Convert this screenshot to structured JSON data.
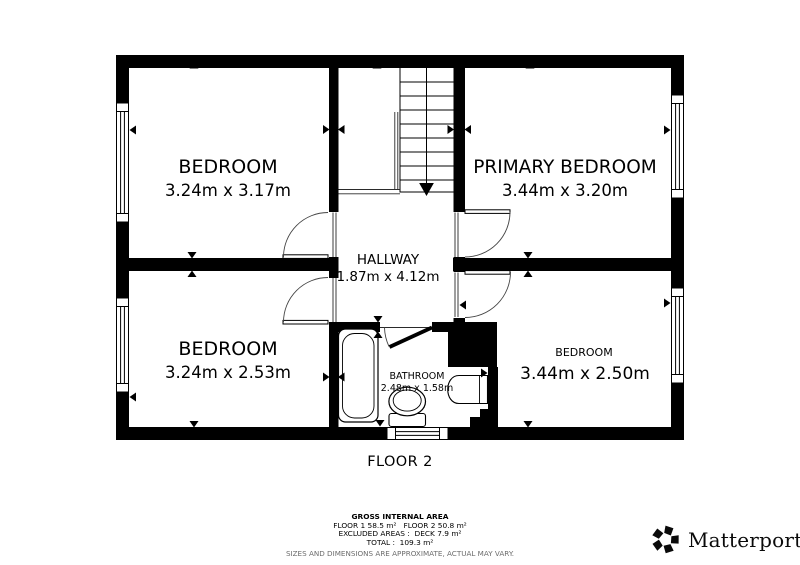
{
  "floor_label": "FLOOR 2",
  "rooms": {
    "bedroom_tl": {
      "name": "BEDROOM",
      "dims": "3.24m x 3.17m"
    },
    "primary": {
      "name": "PRIMARY BEDROOM",
      "dims": "3.44m x 3.20m"
    },
    "hallway": {
      "name": "HALLWAY",
      "dims": "1.87m x 4.12m"
    },
    "bedroom_bl": {
      "name": "BEDROOM",
      "dims": "3.24m x 2.53m"
    },
    "bathroom": {
      "name": "BATHROOM",
      "dims": "2.48m x 1.58m"
    },
    "bedroom_br": {
      "name": "BEDROOM",
      "dims": "3.44m x 2.50m"
    }
  },
  "footer": {
    "title": "GROSS INTERNAL AREA",
    "line_floors": "FLOOR 1 58.5 m²   FLOOR 2 50.8 m²",
    "line_excluded": "EXCLUDED AREAS :  DECK 7.9 m²",
    "line_total": "TOTAL :  109.3 m²",
    "disclaimer": "SIZES AND DIMENSIONS ARE APPROXIMATE, ACTUAL MAY VARY."
  },
  "brand": {
    "name": "Matterport",
    "reg": "®"
  },
  "colors": {
    "wall": "#000000",
    "background": "#ffffff",
    "door_arc": "#444444",
    "disclaimer_text": "#6d6d6d"
  }
}
